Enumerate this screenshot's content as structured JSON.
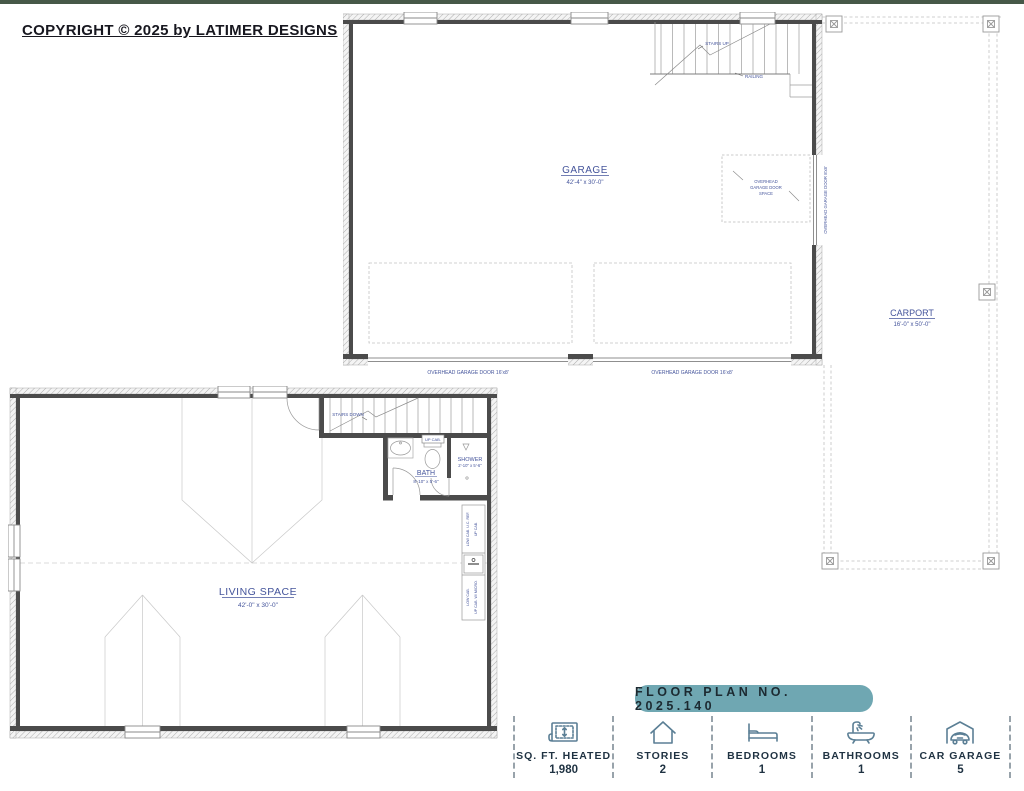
{
  "copyright": "COPYRIGHT © 2025 by LATIMER DESIGNS",
  "garage_plan": {
    "room": "GARAGE",
    "dims": "42'-4\" x 30'-0\"",
    "stairs": "STAIRS UP",
    "railing": "RAILING",
    "door_space_line1": "OVERHEAD",
    "door_space_line2": "GARAGE DOOR",
    "door_space_line3": "SPACE",
    "door_bottom_left": "OVERHEAD GARAGE DOOR 16'x8'",
    "door_bottom_right": "OVERHEAD GARAGE DOOR 16'x8'",
    "door_side": "OVERHEAD GARAGE DOOR 8'x8'"
  },
  "carport": {
    "room": "CARPORT",
    "dims": "16'-0\" x 50'-0\""
  },
  "living_plan": {
    "room": "LIVING SPACE",
    "dims": "42'-0\" x 30'-0\"",
    "stairs": "STAIRS DOWN",
    "bath": "BATH",
    "bath_dims": "8'-10\" x 5'-6\"",
    "shower": "SHOWER",
    "shower_dims": "2'-10\" x 5'-6\"",
    "up_cab": "UP CAB.",
    "cab_top_a": "LOW CAB. U.C. REF.",
    "cab_top_b": "UP CAB.",
    "cab_bottom_a": "LOW CAB.",
    "cab_bottom_b": "UP CAB. W/ MICRO."
  },
  "banner": {
    "text": "FLOOR PLAN NO. 2025.140"
  },
  "stats": {
    "items": [
      {
        "icon": "blueprint-icon",
        "label": "SQ. FT. HEATED",
        "value": "1,980"
      },
      {
        "icon": "house-icon",
        "label": "STORIES",
        "value": "2"
      },
      {
        "icon": "bed-icon",
        "label": "BEDROOMS",
        "value": "1"
      },
      {
        "icon": "bathtub-icon",
        "label": "BATHROOMS",
        "value": "1"
      },
      {
        "icon": "car-garage-icon",
        "label": "CAR GARAGE",
        "value": "5"
      }
    ]
  },
  "colors": {
    "top_bar_green": "#465848",
    "banner_teal": "#6FA7B2",
    "plan_label_blue": "#44549B",
    "stat_icon_blue": "#5B7F95",
    "stat_text_navy": "#1F3242",
    "wall_dark": "#4B4B4B"
  }
}
